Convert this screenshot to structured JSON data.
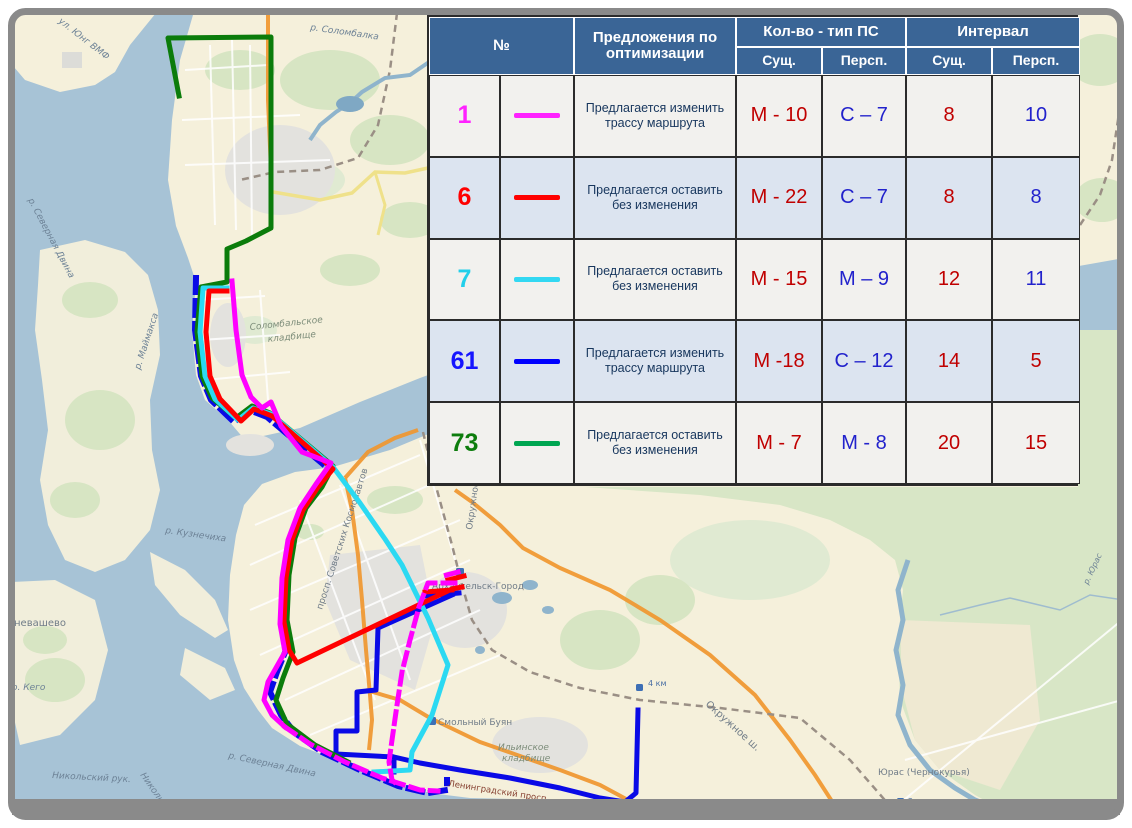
{
  "table": {
    "headers": {
      "num": "№",
      "proposal": "Предложения по оптимизации",
      "group_ps": "Кол-во - тип ПС",
      "group_interval": "Интервал",
      "sub_exist": "Сущ.",
      "sub_persp": "Персп."
    },
    "rows": [
      {
        "num": "1",
        "num_color": "#ff22ff",
        "line_color": "#ff22ff",
        "proposal": "Предлагается изменить трассу маршрута",
        "ps_exist": "М - 10",
        "ps_persp": "С – 7",
        "int_exist": "8",
        "int_persp": "10",
        "int_persp_color": "#2222cc"
      },
      {
        "num": "6",
        "num_color": "#ff0000",
        "line_color": "#ff0000",
        "proposal": "Предлагается оставить без изменения",
        "ps_exist": "М - 22",
        "ps_persp": "С – 7",
        "int_exist": "8",
        "int_persp": "8",
        "int_persp_color": "#2222cc"
      },
      {
        "num": "7",
        "num_color": "#22cfea",
        "line_color": "#33d8f2",
        "proposal": "Предлагается оставить без изменения",
        "ps_exist": "М - 15",
        "ps_persp": "М – 9",
        "int_exist": "12",
        "int_persp": "11",
        "int_persp_color": "#2222cc"
      },
      {
        "num": "61",
        "num_color": "#1515ff",
        "line_color": "#0000ff",
        "proposal": "Предлагается изменить трассу маршрута",
        "ps_exist": "М -18",
        "ps_persp": "С – 12",
        "int_exist": "14",
        "int_persp": "5",
        "int_persp_color": "#c00000"
      },
      {
        "num": "73",
        "num_color": "#0d7d0d",
        "line_color": "#00a651",
        "proposal": "Предлагается оставить без изменения",
        "ps_exist": "М - 7",
        "ps_persp": "М - 8",
        "int_exist": "20",
        "int_persp": "15",
        "int_persp_color": "#c00000"
      }
    ]
  },
  "map": {
    "route_colors": {
      "magenta": "#ff00ff",
      "red": "#ff0000",
      "cyan": "#2bd9f2",
      "blue": "#0a0ae6",
      "green": "#0b7c0b"
    },
    "labels": {
      "yung_vmf": "ул. Юнг ВМФ",
      "sev_dvina": "р. Северная Двина",
      "maimaksa": "р. Маймакса",
      "solombalka": "р. Соломбалка",
      "solomb_cem_1": "Соломбальское",
      "solomb_cem_2": "кладбище",
      "kuznechikha": "р. Кузнечиха",
      "nevashevo": "невашево",
      "kego": "о. Кего",
      "nikolsky": "Никольский рук.",
      "kosmonavtov": "просп. Советских Космонавтов",
      "smolny": "Смольный Буян",
      "ilinskoe_1": "Ильинское",
      "ilinskoe_2": "кладбище",
      "arkh_gorod": "Архангельск-Город",
      "okruzhnoe": "Окружное ш.",
      "yuras_village": "Юрас (Чернокурья)",
      "yuras_river": "р. Юрас",
      "km4": "4 км",
      "km2": "2 км",
      "leningradsky": "Ленинградский просп."
    }
  }
}
